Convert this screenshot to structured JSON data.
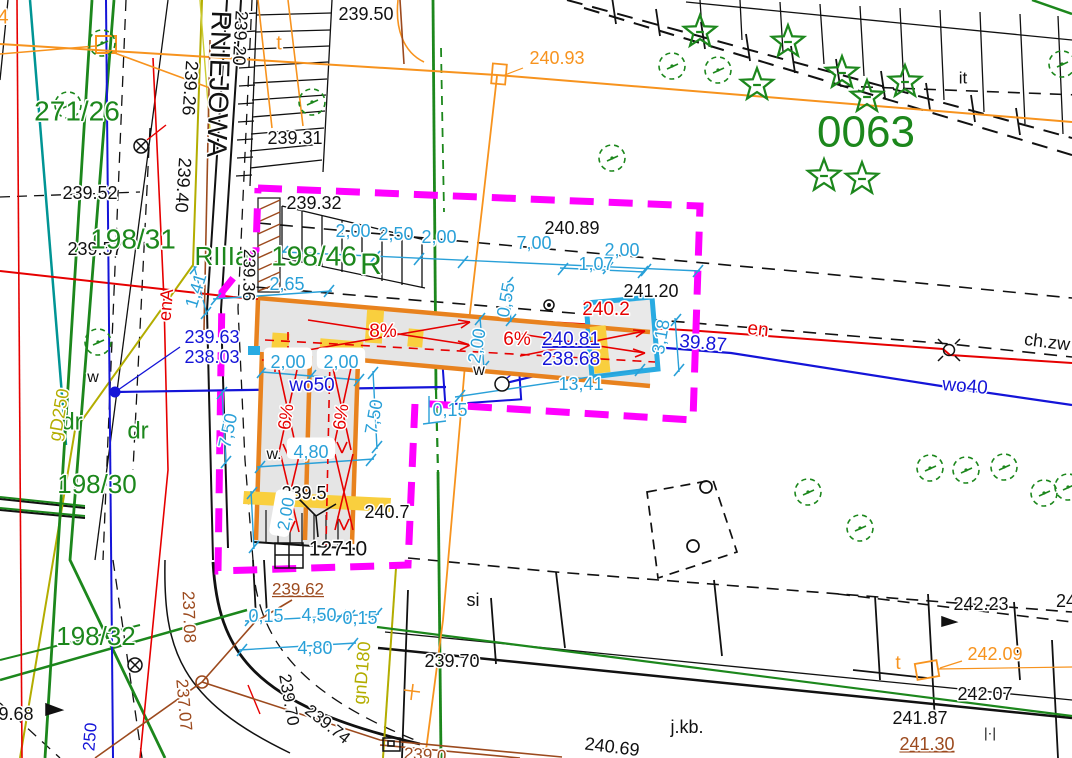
{
  "meta": {
    "title": "Geodetic site plan",
    "width": 1072,
    "height": 758,
    "sheet_id": "0063"
  },
  "colors": {
    "k": "#111111",
    "g": "#1c871c",
    "c": "#29A0D8",
    "b": "#1414d8",
    "r": "#e60000",
    "o": "#F7931E",
    "m": "#FF00FF",
    "n": "#9C4A1E",
    "y": "#b3ad00",
    "grey_fill": "#e5e5e5",
    "cyan_box": "#29ABE2",
    "yellow_fill": "#F9CF3E"
  },
  "labels": [
    {
      "t": "239.50",
      "x": 366,
      "y": 15,
      "c": "k",
      "s": 18
    },
    {
      "t": "239.20",
      "x": 239,
      "y": 38,
      "c": "k",
      "s": 18,
      "r": 93
    },
    {
      "t": "239.26",
      "x": 189,
      "y": 88,
      "c": "k",
      "s": 18,
      "r": 94
    },
    {
      "t": "239.40",
      "x": 182,
      "y": 185,
      "c": "k",
      "s": 18,
      "r": 94
    },
    {
      "t": "RNIEJOWA",
      "x": 217,
      "y": 84,
      "c": "k",
      "s": 28,
      "r": 92
    },
    {
      "t": "239.31",
      "x": 295,
      "y": 139,
      "c": "k",
      "s": 18
    },
    {
      "t": "t",
      "x": 279,
      "y": 44,
      "c": "o",
      "s": 20
    },
    {
      "t": "240.93",
      "x": 557,
      "y": 59,
      "c": "o",
      "s": 18
    },
    {
      "t": "4",
      "x": 3,
      "y": 18,
      "c": "o",
      "s": 20
    },
    {
      "t": "271/26",
      "x": 77,
      "y": 113,
      "c": "g",
      "s": 28
    },
    {
      "t": "239.52",
      "x": 90,
      "y": 194,
      "c": "k",
      "s": 18
    },
    {
      "t": "239.57",
      "x": 95,
      "y": 250,
      "c": "k",
      "s": 18
    },
    {
      "t": "198/31",
      "x": 133,
      "y": 241,
      "c": "g",
      "s": 28
    },
    {
      "t": "RIIIa",
      "x": 222,
      "y": 258,
      "c": "g",
      "s": 26
    },
    {
      "t": "198/46",
      "x": 314,
      "y": 258,
      "c": "g",
      "s": 28
    },
    {
      "t": "R",
      "x": 371,
      "y": 266,
      "c": "g",
      "s": 30
    },
    {
      "t": "239.32",
      "x": 314,
      "y": 204,
      "c": "k",
      "s": 18
    },
    {
      "t": "239.36",
      "x": 248,
      "y": 275,
      "c": "k",
      "s": 17,
      "r": 91
    },
    {
      "t": "0063",
      "x": 866,
      "y": 135,
      "c": "g",
      "s": 44
    },
    {
      "t": "it",
      "x": 963,
      "y": 79,
      "c": "k",
      "s": 17
    },
    {
      "t": "240.89",
      "x": 572,
      "y": 229,
      "c": "k",
      "s": 18
    },
    {
      "t": "2,00",
      "x": 353,
      "y": 232,
      "c": "c",
      "s": 18
    },
    {
      "t": "2,50",
      "x": 396,
      "y": 235,
      "c": "c",
      "s": 18
    },
    {
      "t": "2,00",
      "x": 439,
      "y": 238,
      "c": "c",
      "s": 18
    },
    {
      "t": "7,00",
      "x": 534,
      "y": 244,
      "c": "c",
      "s": 18
    },
    {
      "t": "2,00",
      "x": 622,
      "y": 251,
      "c": "c",
      "s": 18
    },
    {
      "t": "1,07",
      "x": 596,
      "y": 265,
      "c": "c",
      "s": 18
    },
    {
      "t": "2,65",
      "x": 287,
      "y": 285,
      "c": "c",
      "s": 18
    },
    {
      "t": "1,41",
      "x": 197,
      "y": 291,
      "c": "c",
      "s": 18,
      "r": -73
    },
    {
      "t": "241.20",
      "x": 651,
      "y": 292,
      "c": "k",
      "s": 18
    },
    {
      "t": "240.2",
      "x": 606,
      "y": 310,
      "c": "r",
      "s": 19
    },
    {
      "t": "0,55",
      "x": 507,
      "y": 300,
      "c": "c",
      "s": 18,
      "r": -80
    },
    {
      "t": "8%",
      "x": 383,
      "y": 332,
      "c": "r",
      "s": 19
    },
    {
      "t": "6%",
      "x": 517,
      "y": 340,
      "c": "r",
      "s": 19
    },
    {
      "t": "240.81",
      "x": 571,
      "y": 340,
      "c": "b",
      "s": 19,
      "u": 1
    },
    {
      "t": "238.68",
      "x": 571,
      "y": 360,
      "c": "b",
      "s": 19
    },
    {
      "t": "3,18",
      "x": 662,
      "y": 337,
      "c": "c",
      "s": 18,
      "r": -80
    },
    {
      "t": "39.87",
      "x": 703,
      "y": 344,
      "c": "b",
      "s": 19,
      "r": 5
    },
    {
      "t": "en",
      "x": 758,
      "y": 330,
      "c": "r",
      "s": 19,
      "r": 6
    },
    {
      "t": "enA",
      "x": 167,
      "y": 305,
      "c": "r",
      "s": 18,
      "r": -85
    },
    {
      "t": "239.63",
      "x": 212,
      "y": 338,
      "c": "b",
      "s": 18
    },
    {
      "t": "238.03",
      "x": 212,
      "y": 358,
      "c": "b",
      "s": 18
    },
    {
      "t": "w",
      "x": 93,
      "y": 378,
      "c": "k",
      "s": 16
    },
    {
      "t": "w",
      "x": 479,
      "y": 371,
      "c": "k",
      "s": 16
    },
    {
      "t": "wo50",
      "x": 312,
      "y": 386,
      "c": "b",
      "s": 19
    },
    {
      "t": "2,00",
      "x": 288,
      "y": 363,
      "c": "c",
      "s": 18,
      "bg": 1
    },
    {
      "t": "2,00",
      "x": 341,
      "y": 363,
      "c": "c",
      "s": 18,
      "bg": 1
    },
    {
      "t": "dr",
      "x": 72,
      "y": 423,
      "c": "g",
      "s": 24
    },
    {
      "t": "dr",
      "x": 138,
      "y": 432,
      "c": "g",
      "s": 24
    },
    {
      "t": "gD250",
      "x": 60,
      "y": 415,
      "c": "y",
      "s": 18,
      "r": -80
    },
    {
      "t": "198/30",
      "x": 97,
      "y": 486,
      "c": "g",
      "s": 26
    },
    {
      "t": "6%",
      "x": 287,
      "y": 417,
      "c": "r",
      "s": 18,
      "r": -82
    },
    {
      "t": "6%",
      "x": 342,
      "y": 417,
      "c": "r",
      "s": 18,
      "r": -82
    },
    {
      "t": "7,50",
      "x": 229,
      "y": 431,
      "c": "c",
      "s": 18,
      "r": -78
    },
    {
      "t": "7,50",
      "x": 375,
      "y": 417,
      "c": "c",
      "s": 18,
      "r": -80
    },
    {
      "t": "2,00",
      "x": 478,
      "y": 346,
      "c": "c",
      "s": 18,
      "r": -80
    },
    {
      "t": "0,15",
      "x": 450,
      "y": 411,
      "c": "c",
      "s": 18
    },
    {
      "t": "13,41",
      "x": 581,
      "y": 385,
      "c": "c",
      "s": 18
    },
    {
      "t": "w.",
      "x": 274,
      "y": 455,
      "c": "k",
      "s": 16
    },
    {
      "t": "4,80",
      "x": 311,
      "y": 453,
      "c": "c",
      "s": 18,
      "bg": 1
    },
    {
      "t": "239.5",
      "x": 304,
      "y": 494,
      "c": "k",
      "s": 18
    },
    {
      "t": "2,00",
      "x": 287,
      "y": 514,
      "c": "c",
      "s": 17,
      "r": -80,
      "bg": 1
    },
    {
      "t": "240.7",
      "x": 387,
      "y": 513,
      "c": "k",
      "s": 18
    },
    {
      "t": "12710",
      "x": 338,
      "y": 550,
      "c": "k",
      "s": 21
    },
    {
      "t": "239.62",
      "x": 298,
      "y": 590,
      "c": "n",
      "s": 17,
      "u": 1
    },
    {
      "t": "0,15",
      "x": 266,
      "y": 617,
      "c": "c",
      "s": 18
    },
    {
      "t": "4,50",
      "x": 319,
      "y": 616,
      "c": "c",
      "s": 18
    },
    {
      "t": "0,15",
      "x": 360,
      "y": 619,
      "c": "c",
      "s": 18
    },
    {
      "t": "4,80",
      "x": 315,
      "y": 649,
      "c": "c",
      "s": 18
    },
    {
      "t": "gnD180",
      "x": 363,
      "y": 673,
      "c": "y",
      "s": 18,
      "r": -85
    },
    {
      "t": "237.08",
      "x": 188,
      "y": 617,
      "c": "n",
      "s": 17,
      "r": 88
    },
    {
      "t": "237.07",
      "x": 183,
      "y": 705,
      "c": "n",
      "s": 17,
      "r": 85
    },
    {
      "t": "239.70",
      "x": 288,
      "y": 700,
      "c": "k",
      "s": 17,
      "r": 80
    },
    {
      "t": "239.74",
      "x": 327,
      "y": 725,
      "c": "k",
      "s": 17,
      "r": 38
    },
    {
      "t": "198/32",
      "x": 96,
      "y": 638,
      "c": "g",
      "s": 26
    },
    {
      "t": "9.68",
      "x": 16,
      "y": 715,
      "c": "k",
      "s": 18
    },
    {
      "t": "250",
      "x": 91,
      "y": 737,
      "c": "b",
      "s": 17,
      "r": -85
    },
    {
      "t": "239.70",
      "x": 452,
      "y": 662,
      "c": "k",
      "s": 18
    },
    {
      "t": "si",
      "x": 473,
      "y": 601,
      "c": "k",
      "s": 18
    },
    {
      "t": "j.kb.",
      "x": 687,
      "y": 728,
      "c": "k",
      "s": 18
    },
    {
      "t": "240.69",
      "x": 612,
      "y": 748,
      "c": "k",
      "s": 18,
      "r": 7
    },
    {
      "t": "239.0",
      "x": 425,
      "y": 756,
      "c": "n",
      "s": 17,
      "r": 4
    },
    {
      "t": "242.23",
      "x": 981,
      "y": 605,
      "c": "k",
      "s": 18
    },
    {
      "t": "24",
      "x": 1066,
      "y": 602,
      "c": "k",
      "s": 18
    },
    {
      "t": "t",
      "x": 898,
      "y": 664,
      "c": "o",
      "s": 19
    },
    {
      "t": "242.09",
      "x": 995,
      "y": 655,
      "c": "o",
      "s": 18
    },
    {
      "t": "242.07",
      "x": 985,
      "y": 695,
      "c": "k",
      "s": 18
    },
    {
      "t": "241.87",
      "x": 920,
      "y": 719,
      "c": "k",
      "s": 18
    },
    {
      "t": "241.30",
      "x": 927,
      "y": 745,
      "c": "n",
      "s": 18,
      "u": 1
    },
    {
      "t": "|·|",
      "x": 990,
      "y": 734,
      "c": "k",
      "s": 14
    },
    {
      "t": "ch.zw",
      "x": 1047,
      "y": 343,
      "c": "k",
      "s": 18,
      "r": 7
    },
    {
      "t": "wo40",
      "x": 965,
      "y": 387,
      "c": "b",
      "s": 19,
      "r": 5
    }
  ]
}
